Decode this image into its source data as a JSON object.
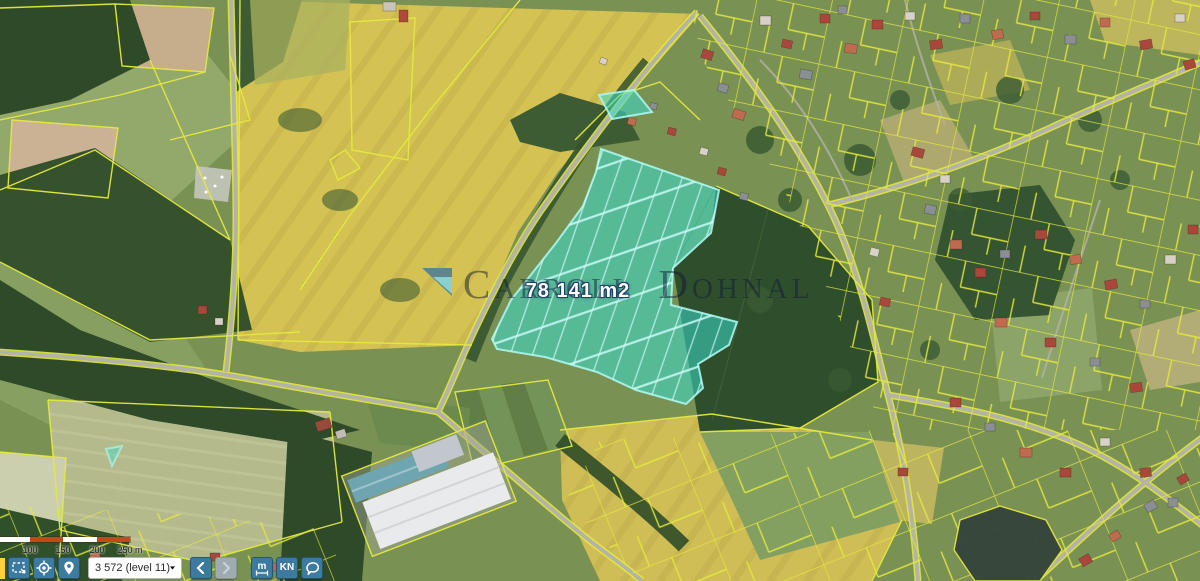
{
  "map": {
    "watermark": {
      "word1": "Carroll",
      "word2": "Dohnal",
      "logo": "triangle-logo"
    },
    "selection": {
      "area_label": "78 141 m2"
    }
  },
  "scale_bar": {
    "ticks": [
      "100",
      "150",
      "200",
      "250 m"
    ],
    "segments": 4
  },
  "toolbar": {
    "select_area_button": {
      "icon": "dashed-rectangle-icon"
    },
    "locate_button": {
      "icon": "crosshair-icon"
    },
    "marker_button": {
      "icon": "map-pin-icon"
    },
    "zoom_select": {
      "value": "3 572 (level 11)"
    },
    "back_button": {
      "icon": "chevron-left-icon",
      "enabled": true
    },
    "forward_button": {
      "icon": "chevron-right-icon",
      "enabled": false
    },
    "measure_button": {
      "label": "m",
      "icon": "measure-icon"
    },
    "kn_button": {
      "label": "KN"
    },
    "lasso_button": {
      "icon": "lasso-icon"
    }
  },
  "colors": {
    "selection_fill": "#3BDCCE",
    "selection_line": "#A9F6EE",
    "parcel_line": "#E4E93E",
    "button_bg": "#3D7AA0",
    "button_disabled_bg": "#9FABB1",
    "scale_orange": "#C1491A"
  }
}
